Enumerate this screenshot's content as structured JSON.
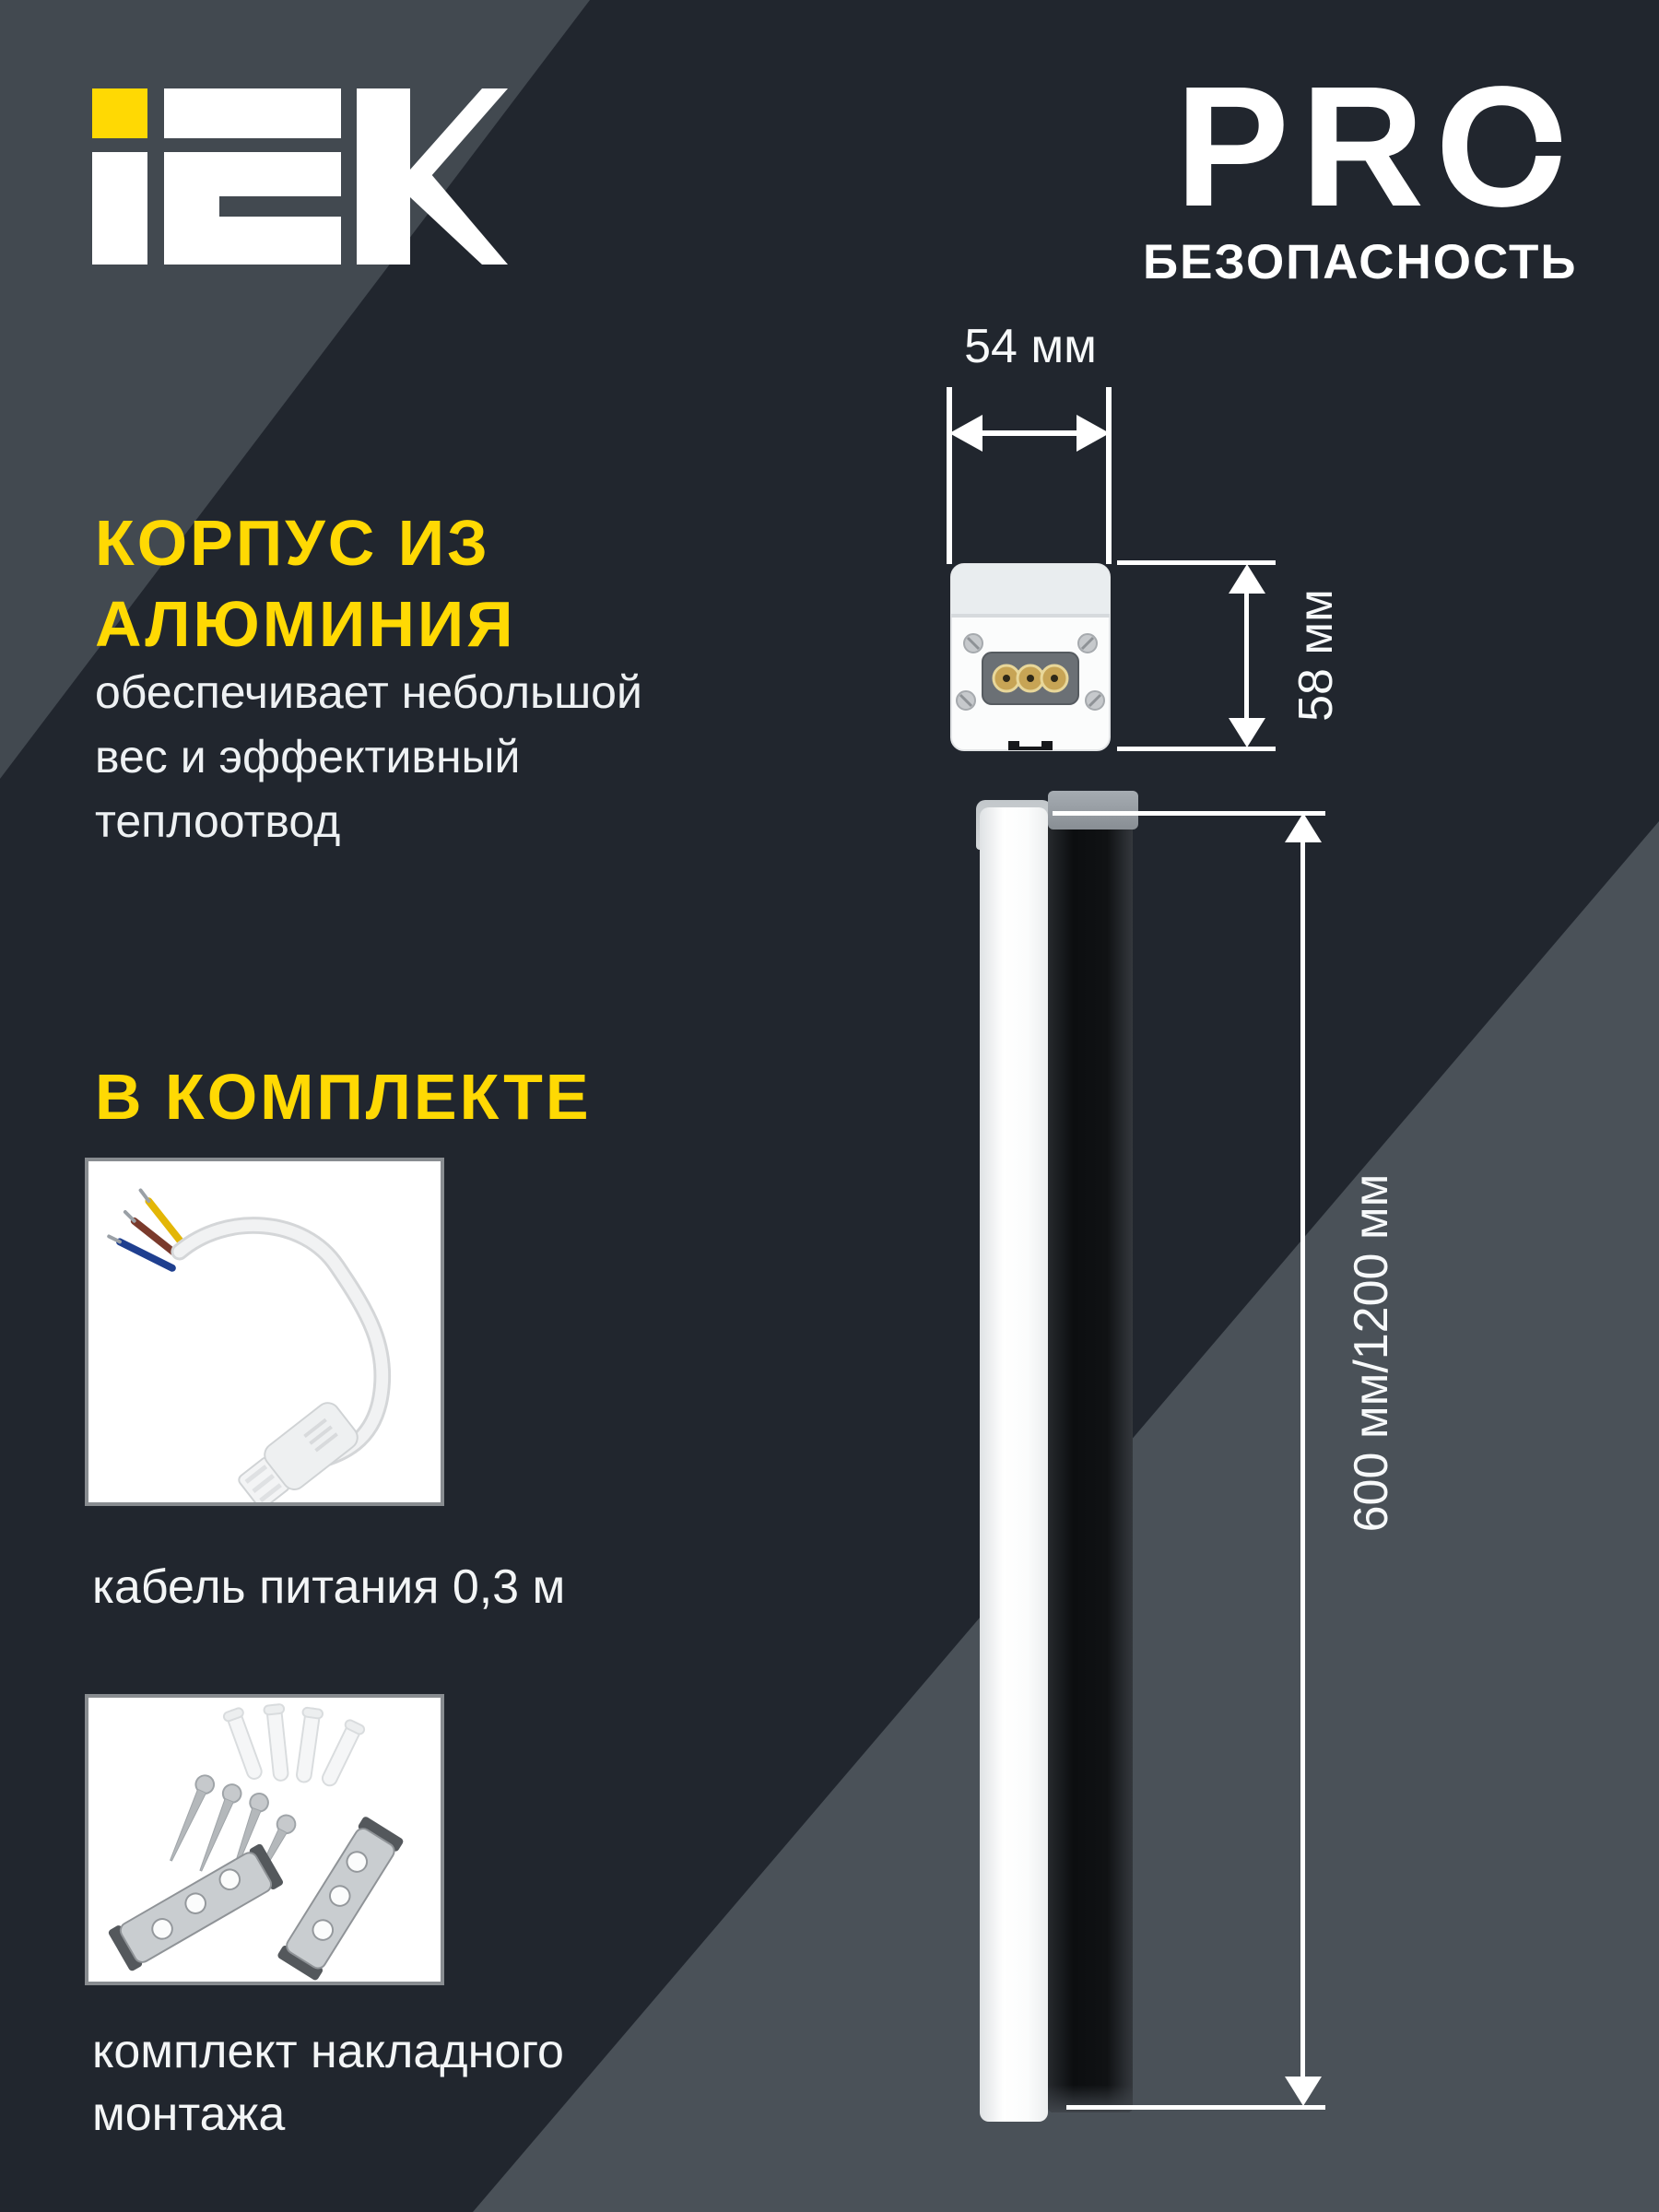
{
  "brand": {
    "logo_alt": "IEK",
    "pro_label": "PRO",
    "pro_sublabel": "БЕЗОПАСНОСТЬ"
  },
  "palette": {
    "accent_yellow": "#FFD903",
    "background_dark": "#21262E",
    "background_light_top": "#424950",
    "background_light_bottom": "#4A5158",
    "text_white": "#F3F5F6"
  },
  "feature": {
    "title_line1": "КОРПУС ИЗ",
    "title_line2": "АЛЮМИНИЯ",
    "body_line1": "обеспечивает небольшой",
    "body_line2": "вес и эффективный",
    "body_line3": "теплоотвод"
  },
  "included": {
    "title": "В КОМПЛЕКТЕ",
    "items": [
      {
        "image": "power-cable-photo",
        "caption": "кабель питания 0,3 м"
      },
      {
        "image": "mounting-kit-photo",
        "caption_line1": "комплект накладного",
        "caption_line2": "монтажа"
      }
    ]
  },
  "dimensions": {
    "width_label": "54 мм",
    "height_label": "58 мм",
    "length_label": "600 мм/1200 мм"
  }
}
